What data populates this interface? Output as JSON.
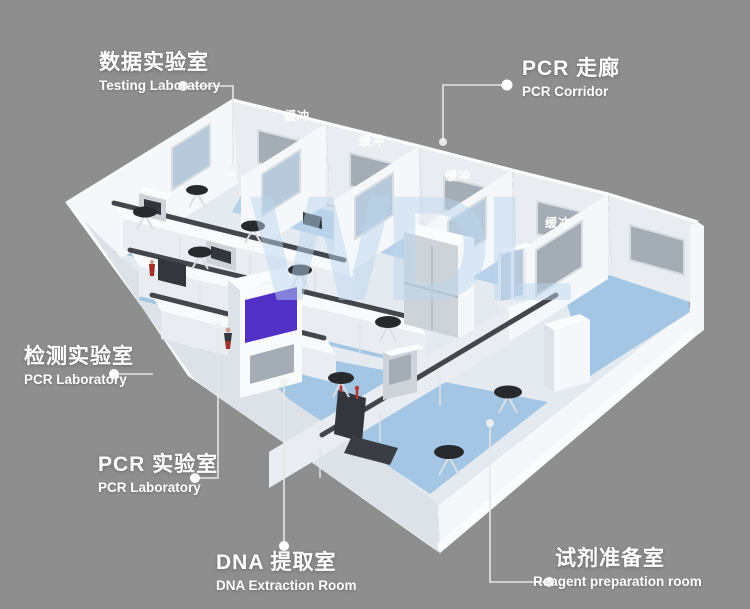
{
  "scene": {
    "watermark": "WDL",
    "buffer_label": "缓冲"
  },
  "callouts": {
    "testing_lab": {
      "zh": "数据实验室",
      "en": "Testing Laboratory"
    },
    "pcr_corridor": {
      "zh": "PCR 走廊",
      "en": "PCR Corridor"
    },
    "inspection_lab": {
      "zh": "检测实验室",
      "en": "PCR Laboratory"
    },
    "pcr_lab": {
      "zh": "PCR 实验室",
      "en": "PCR Laboratory"
    },
    "dna_extraction": {
      "zh": "DNA 提取室",
      "en": "DNA Extraction Room"
    },
    "reagent_prep": {
      "zh": "试剂准备室",
      "en": "Reagent preparation room"
    }
  },
  "colors": {
    "background": "#8e8e8e",
    "wall_bright": "#f5f7fa",
    "wall_mid": "#e9edf2",
    "wall_shadow": "#dde2e8",
    "floor_white": "#e4eaf0",
    "floor_blue": "#a3c6e4",
    "floor_blue_light": "#b7d1ea",
    "glass_gray": "#a4adb6",
    "glass_blue": "#b7c9da",
    "countertop_edge": "#43474d",
    "equipment_dark": "#33373c",
    "accent_purple": "#5130c6",
    "stool_dark": "#27292d",
    "leader_line": "#e6e6e6",
    "label_text": "#ffffff",
    "watermark_blue": "#bcd6ee"
  }
}
